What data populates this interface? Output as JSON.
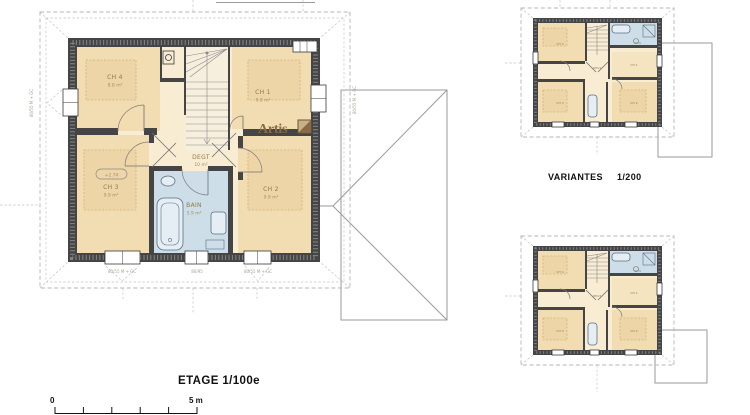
{
  "titles": {
    "main": "ETAGE 1/100e",
    "variants": "VARIANTES",
    "variants_scale": "1/200"
  },
  "scale_bar": {
    "zero": "0",
    "five": "5 m"
  },
  "logo": {
    "name": "Artis"
  },
  "colors": {
    "wall": "#454545",
    "room_cream": "#f8ecd2",
    "room_tan": "#f2dcb2",
    "bath_blue": "#cddee9",
    "logo_brown": "#8a6a43"
  },
  "main_plan": {
    "rooms": {
      "ch4": {
        "name": "CH 4",
        "area": "8.8 m²"
      },
      "ch1": {
        "name": "CH 1",
        "area": "9.8 m²"
      },
      "ch3": {
        "name": "CH 3",
        "area": "9.9 m²"
      },
      "ch2": {
        "name": "CH 2",
        "area": "9.9 m²"
      },
      "deg": {
        "name": "DEGT",
        "area": "10 m²"
      },
      "bain": {
        "name": "BAIN",
        "area": "5.9 m²"
      }
    },
    "level_marker": "+2.74",
    "dims": {
      "bottom_left": "80/55 M + GC",
      "bottom_center": "80/95",
      "bottom_right": "80/55 M + GC",
      "left": "80/55 M + GC",
      "right": "80/55 M + GC"
    }
  }
}
